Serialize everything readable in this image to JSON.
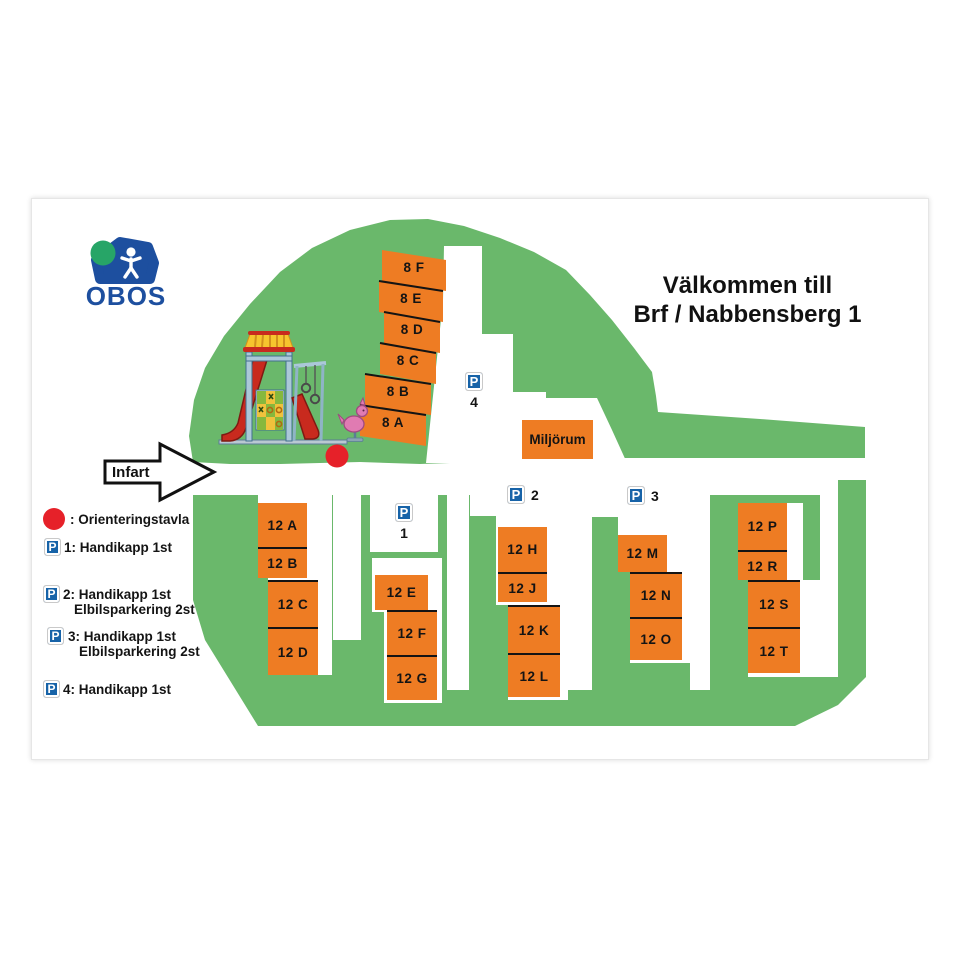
{
  "logo": {
    "text": "OBOS",
    "icon": "obos-house-logo"
  },
  "title": {
    "line1": "Välkommen till",
    "line2": "Brf / Nabbensberg 1"
  },
  "entrance": {
    "label": "Infart"
  },
  "miljorum_label": "Miljörum",
  "buildings": [
    "8 F",
    "8 E",
    "8 D",
    "8 C",
    "8 B",
    "8 A",
    "12 A",
    "12 B",
    "12 C",
    "12 D",
    "12 E",
    "12 F",
    "12 G",
    "12 H",
    "12 J",
    "12 K",
    "12 L",
    "12 M",
    "12 N",
    "12 O",
    "12 P",
    "12 R",
    "12 S",
    "12 T"
  ],
  "parking_signs": {
    "letter": "P",
    "p1": "1",
    "p2": "2",
    "p3": "3",
    "p4": "4"
  },
  "legend": {
    "items": [
      {
        "icon": "red-dot",
        "line1": ": Orienteringstavla"
      },
      {
        "icon": "parking-sign",
        "letter": "P",
        "line1": "1: Handikapp 1st"
      },
      {
        "icon": "parking-sign",
        "letter": "P",
        "line1": "2: Handikapp 1st",
        "line2": "Elbilsparkering 2st"
      },
      {
        "icon": "parking-sign",
        "letter": "P",
        "line1": "3: Handikapp 1st",
        "line2": "Elbilsparkering 2st"
      },
      {
        "icon": "parking-sign",
        "letter": "P",
        "line1": "4: Handikapp 1st"
      }
    ]
  },
  "colors": {
    "grass_green": "#6ab86b",
    "building_orange": "#ee7c23",
    "sign_blue": "#1763a8",
    "obos_blue": "#1d4f9f",
    "obos_green": "#27a567",
    "marker_red": "#e62129"
  }
}
